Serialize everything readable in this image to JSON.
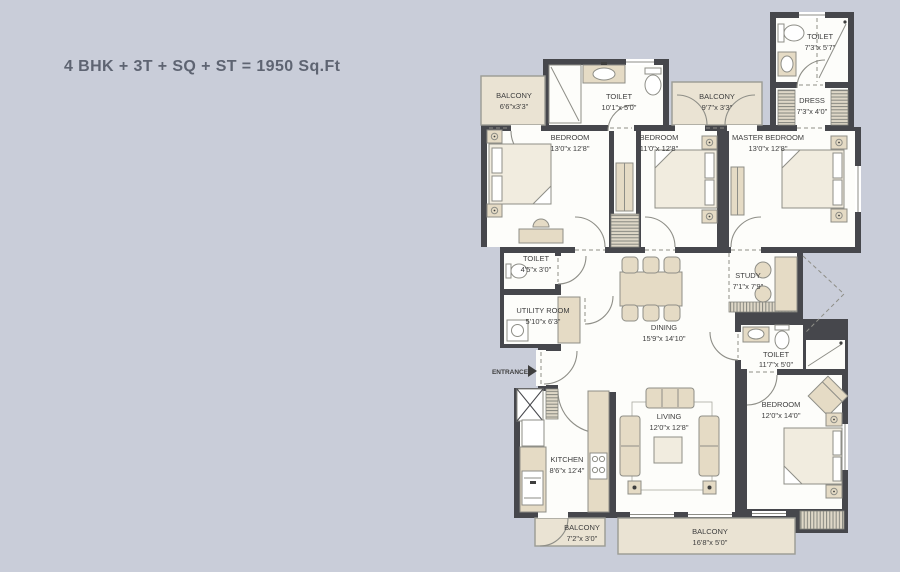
{
  "title": "4 BHK + 3T + SQ + ST  = 1950 Sq.Ft",
  "entrance": {
    "label": "ENTRANCE"
  },
  "colors": {
    "bg": "#c9cdd9",
    "wall": "#46474c",
    "room": "#fdfdfa",
    "balcony": "#eae3d3",
    "furn": "#e5dbc5",
    "bed": "#f1ecdf",
    "label": "#3e3e3e",
    "line": "#8e8e87",
    "title": "#5e6472"
  },
  "rooms": {
    "balcony_nw": {
      "name": "BALCONY",
      "dims": "6'6\"x3'3\""
    },
    "toilet_top": {
      "name": "TOILET",
      "dims": "10'1\"x 5'0\""
    },
    "bedroom1": {
      "name": "BEDROOM",
      "dims": "13'0\"x 12'8\""
    },
    "balcony_n": {
      "name": "BALCONY",
      "dims": "9'7\"x 3'3\""
    },
    "bedroom2": {
      "name": "BEDROOM",
      "dims": "11'0\"x 12'8\""
    },
    "master_bedroom": {
      "name": "MASTER BEDROOM",
      "dims": "13'0\"x 12'8\""
    },
    "toilet_master": {
      "name": "TOILET",
      "dims": "7'3\"x 5'7\""
    },
    "dress": {
      "name": "DRESS",
      "dims": "7'3\"x 4'0\""
    },
    "toilet_powder": {
      "name": "TOILET",
      "dims": "4'5\"x 3'0\""
    },
    "utility": {
      "name": "UTILITY ROOM",
      "dims": "5'10\"x 6'3\""
    },
    "dining": {
      "name": "DINING",
      "dims": "15'9\"x 14'10\""
    },
    "study": {
      "name": "STUDY",
      "dims": "7'1\"x 7'9\""
    },
    "toilet_common": {
      "name": "TOILET",
      "dims": "11'7\"x 5'0\""
    },
    "bedroom4": {
      "name": "BEDROOM",
      "dims": "12'0\"x 14'0\""
    },
    "living": {
      "name": "LIVING",
      "dims": "12'0\"x 12'8\""
    },
    "kitchen": {
      "name": "KITCHEN",
      "dims": "8'6\"x 12'4\""
    },
    "balcony_kitchen": {
      "name": "BALCONY",
      "dims": "7'2\"x 3'0\""
    },
    "balcony_main": {
      "name": "BALCONY",
      "dims": "16'8\"x 5'0\""
    }
  }
}
